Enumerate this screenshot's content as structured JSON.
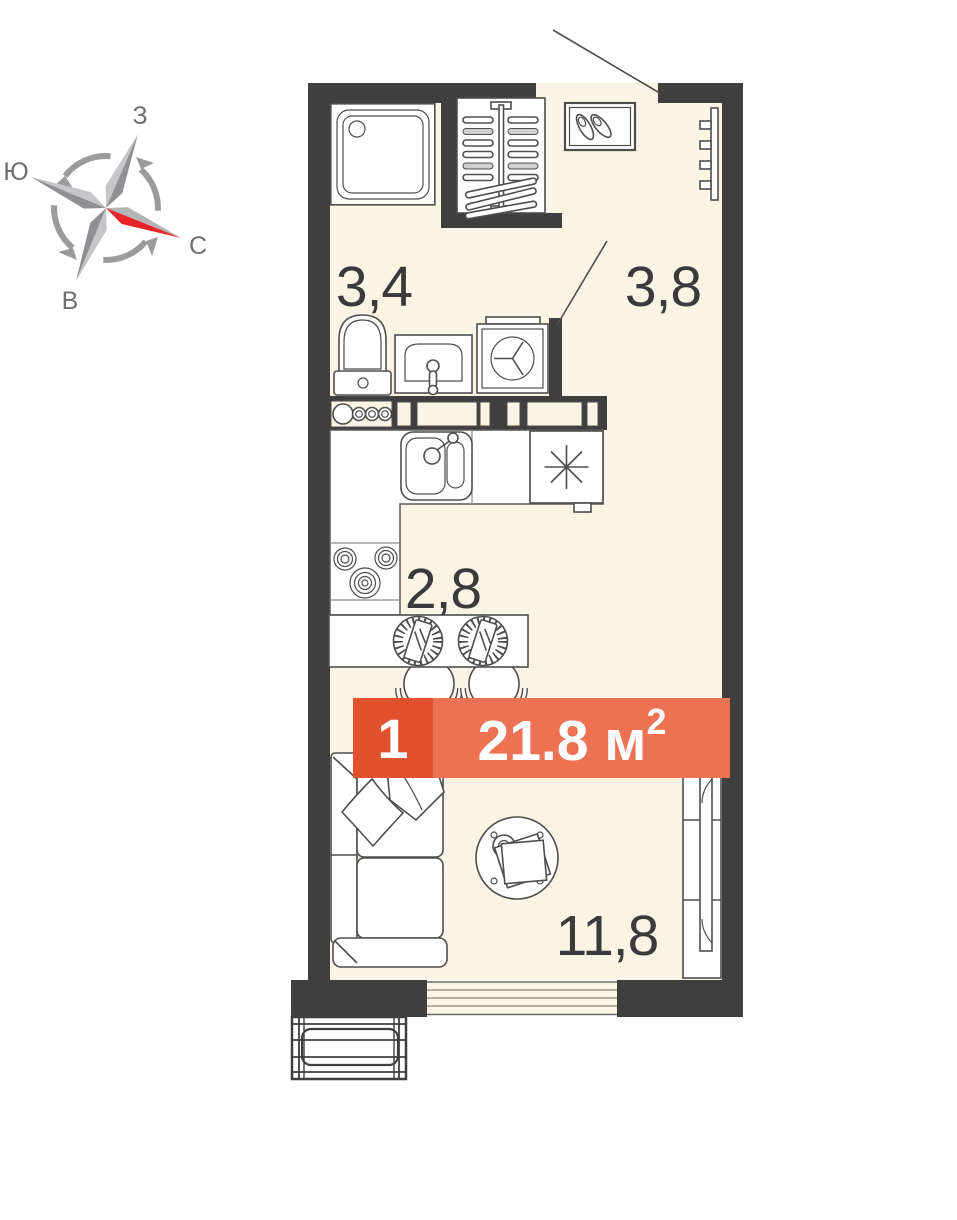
{
  "compass": {
    "top": "З",
    "left": "Ю",
    "right": "С",
    "bottom": "В",
    "north_arrow_color": "#e8242b"
  },
  "rooms": {
    "bathroom": "3,4",
    "hallway": "3,8",
    "kitchen": "2,8",
    "living": "11,8"
  },
  "badge": {
    "room_count": "1",
    "area": "21.8 м",
    "area_superscript": "2"
  },
  "colors": {
    "wall": "#3f3f3f",
    "floor": "#fbf3e3",
    "badge_dark": "#e1512e",
    "badge_light": "#ed7253",
    "outline": "#4e4e4e",
    "label": "#3a3a3a",
    "compass_gray": "#9b9b9d"
  },
  "furniture_icons": [
    "shower-icon",
    "toilet-icon",
    "washbasin-icon",
    "washing-machine-icon",
    "hanger-closet-icon",
    "shoe-cabinet-icon",
    "radiator-icon",
    "kitchen-counter-icon",
    "hob-icon",
    "kitchen-sink-icon",
    "stove-icon",
    "dining-table-icon",
    "place-setting-icon",
    "chair-icon",
    "sofa-icon",
    "pillow-icon",
    "blanket-icon",
    "coffee-table-icon",
    "sliding-wardrobe-icon",
    "window-icon",
    "french-balcony-icon",
    "entrance-door-line",
    "bathroom-door-line"
  ]
}
